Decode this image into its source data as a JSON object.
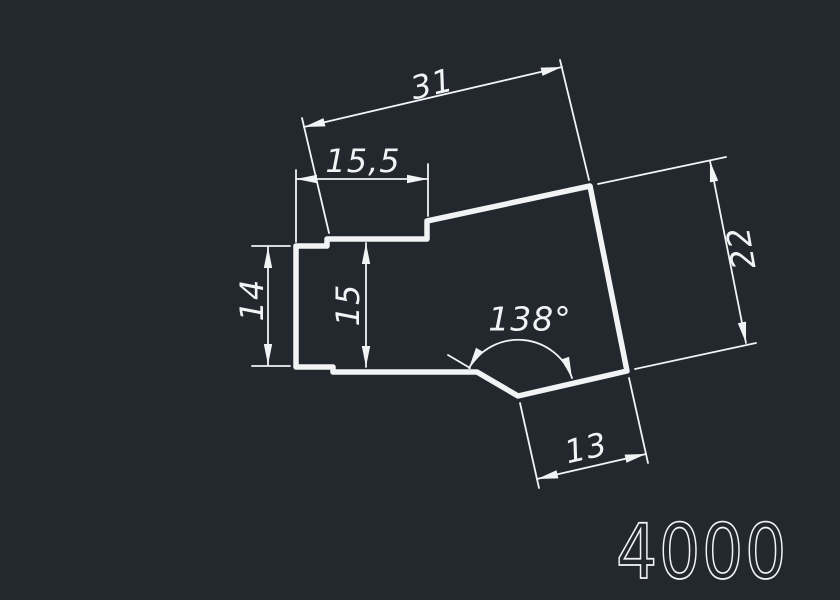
{
  "colors": {
    "background": "#23272e",
    "line": "#f1f3f5"
  },
  "part_label": "4000",
  "dimensions": {
    "width_total": "31",
    "width_upper": "15,5",
    "height_left": "14",
    "height_inner": "15",
    "notch_angle": "138°",
    "notch_width": "13",
    "side_length": "22"
  }
}
